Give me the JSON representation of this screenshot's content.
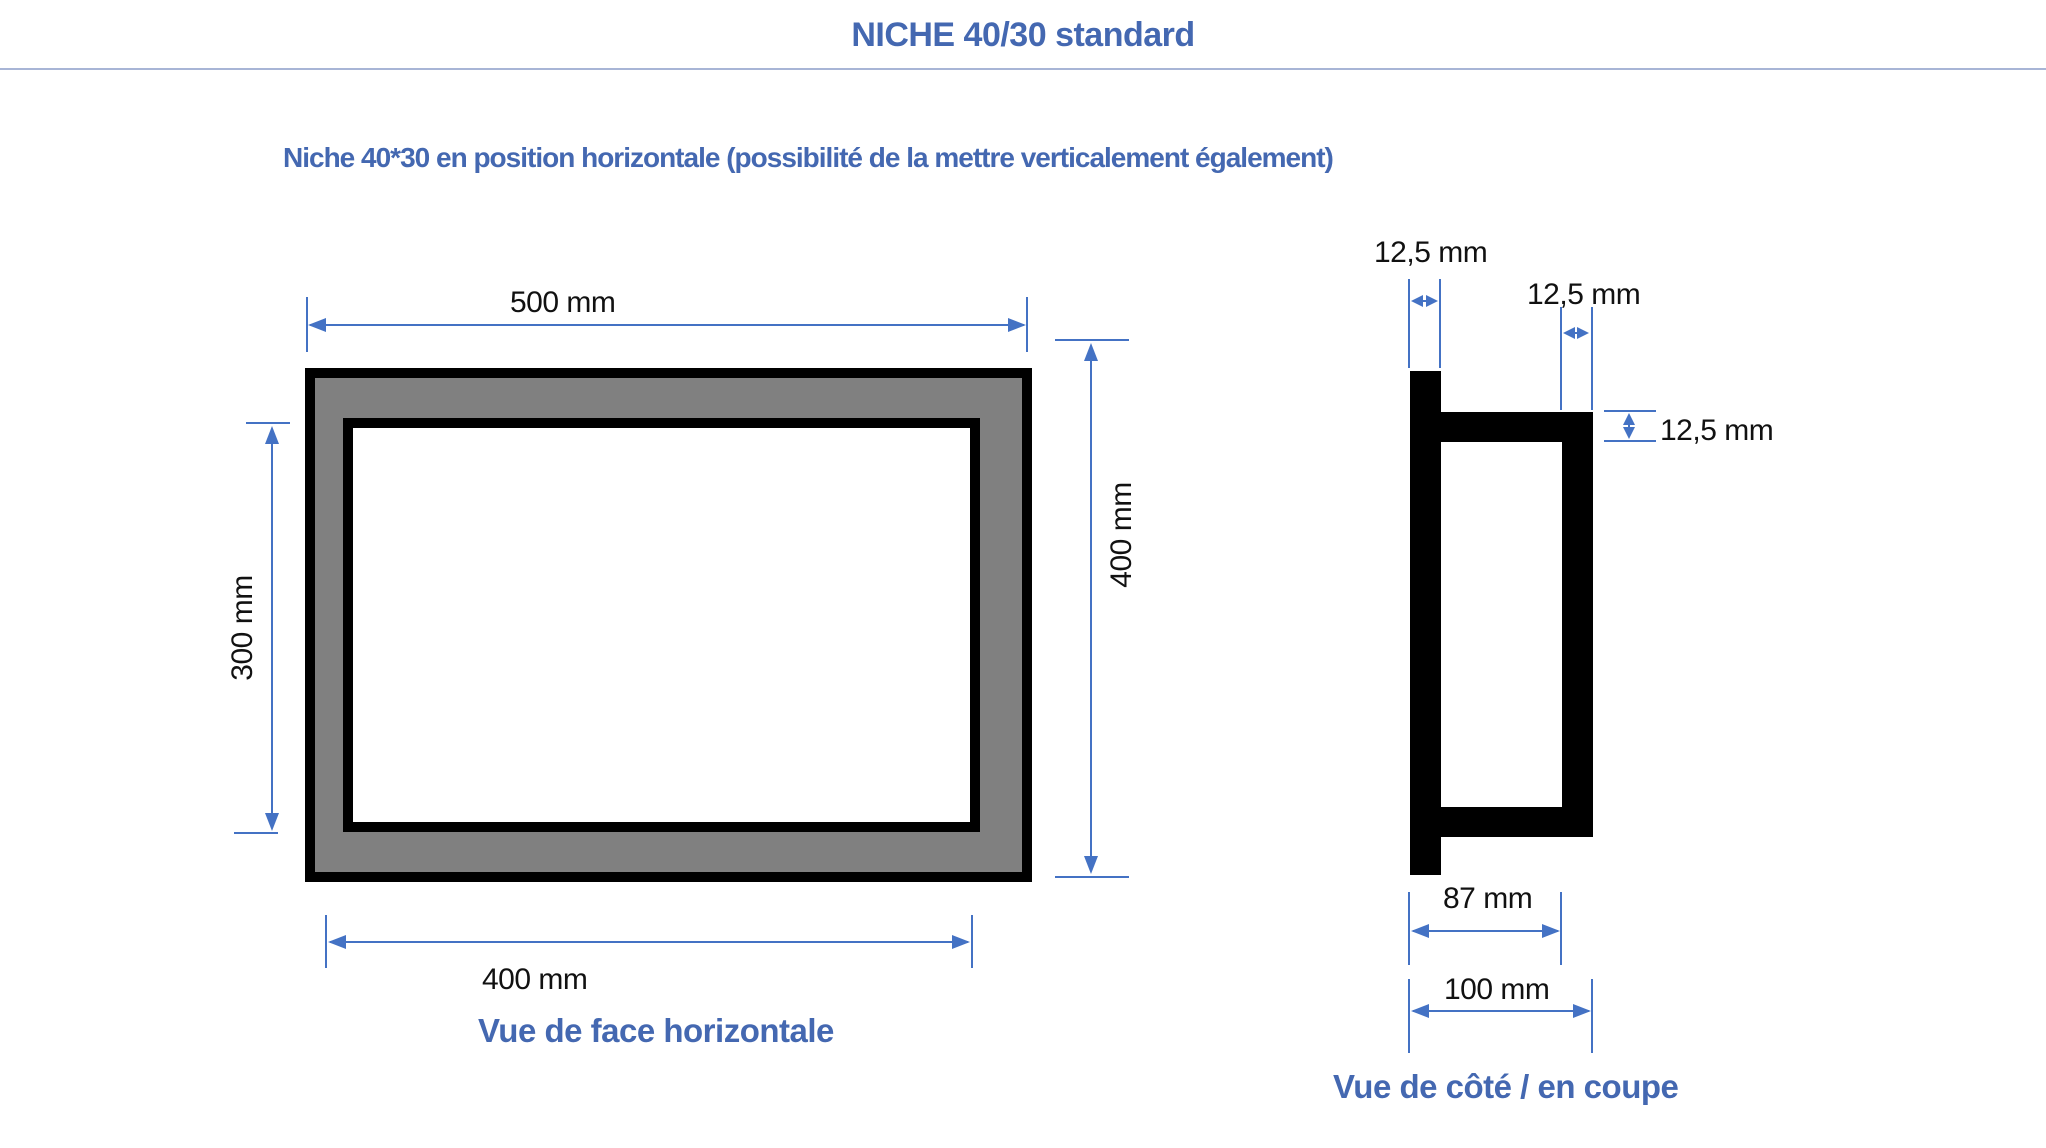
{
  "header": {
    "title": "NICHE 40/30 standard",
    "subtitle": "Niche 40*30 en position horizontale (possibilité de la mettre verticalement également)"
  },
  "front_view": {
    "caption": "Vue de face horizontale",
    "labels": {
      "outer_width": "500 mm",
      "inner_height": "300 mm",
      "outer_height": "400 mm",
      "inner_width": "400 mm"
    },
    "dimensions_mm": {
      "outer_width": 500,
      "outer_height": 400,
      "inner_width": 400,
      "inner_height": 300
    }
  },
  "side_view": {
    "caption": "Vue de côté / en coupe",
    "labels": {
      "front_plate_thickness": "12,5 mm",
      "rear_plate_thickness": "12,5 mm",
      "flange_thickness": "12,5 mm",
      "inner_depth": "87 mm",
      "outer_depth": "100 mm"
    },
    "dimensions_mm": {
      "front_plate_thickness": 12.5,
      "rear_plate_thickness": 12.5,
      "flange_thickness": 12.5,
      "inner_depth": 87,
      "outer_depth": 100
    }
  },
  "colors": {
    "accent_text": "#4468B1",
    "dimension_line": "#4472C4",
    "frame_fill": "#808080",
    "frame_border": "#000000",
    "header_rule": "#a8b5d6"
  }
}
